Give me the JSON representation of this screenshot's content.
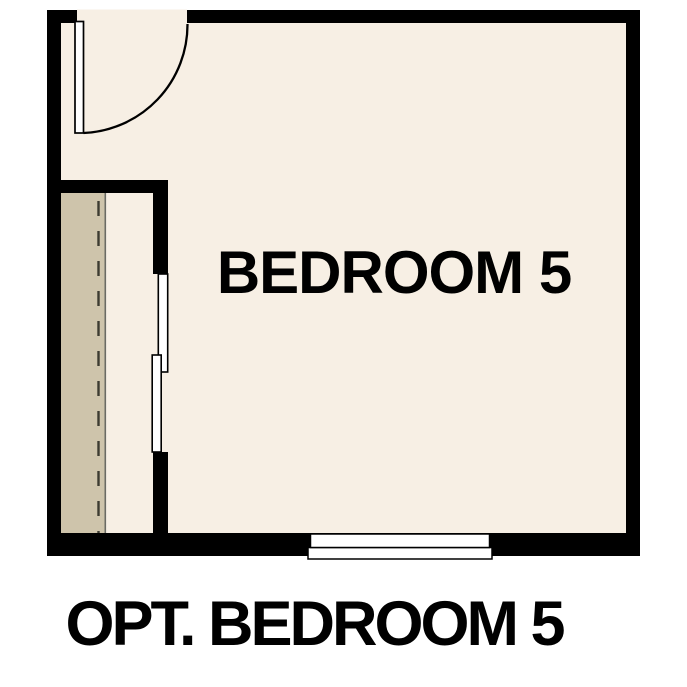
{
  "caption": "OPT. BEDROOM 5",
  "room": {
    "label": "BEDROOM 5"
  },
  "colors": {
    "background": "#ffffff",
    "wall": "#000000",
    "floor": "#f7efe4",
    "closet_shelf": "#cec4ab",
    "door_leaf": "#ffffff",
    "window": "#ffffff",
    "shelf_edge_line": "#6b6b64",
    "rod_dashed_line": "#3c3b31",
    "text": "#000000"
  }
}
